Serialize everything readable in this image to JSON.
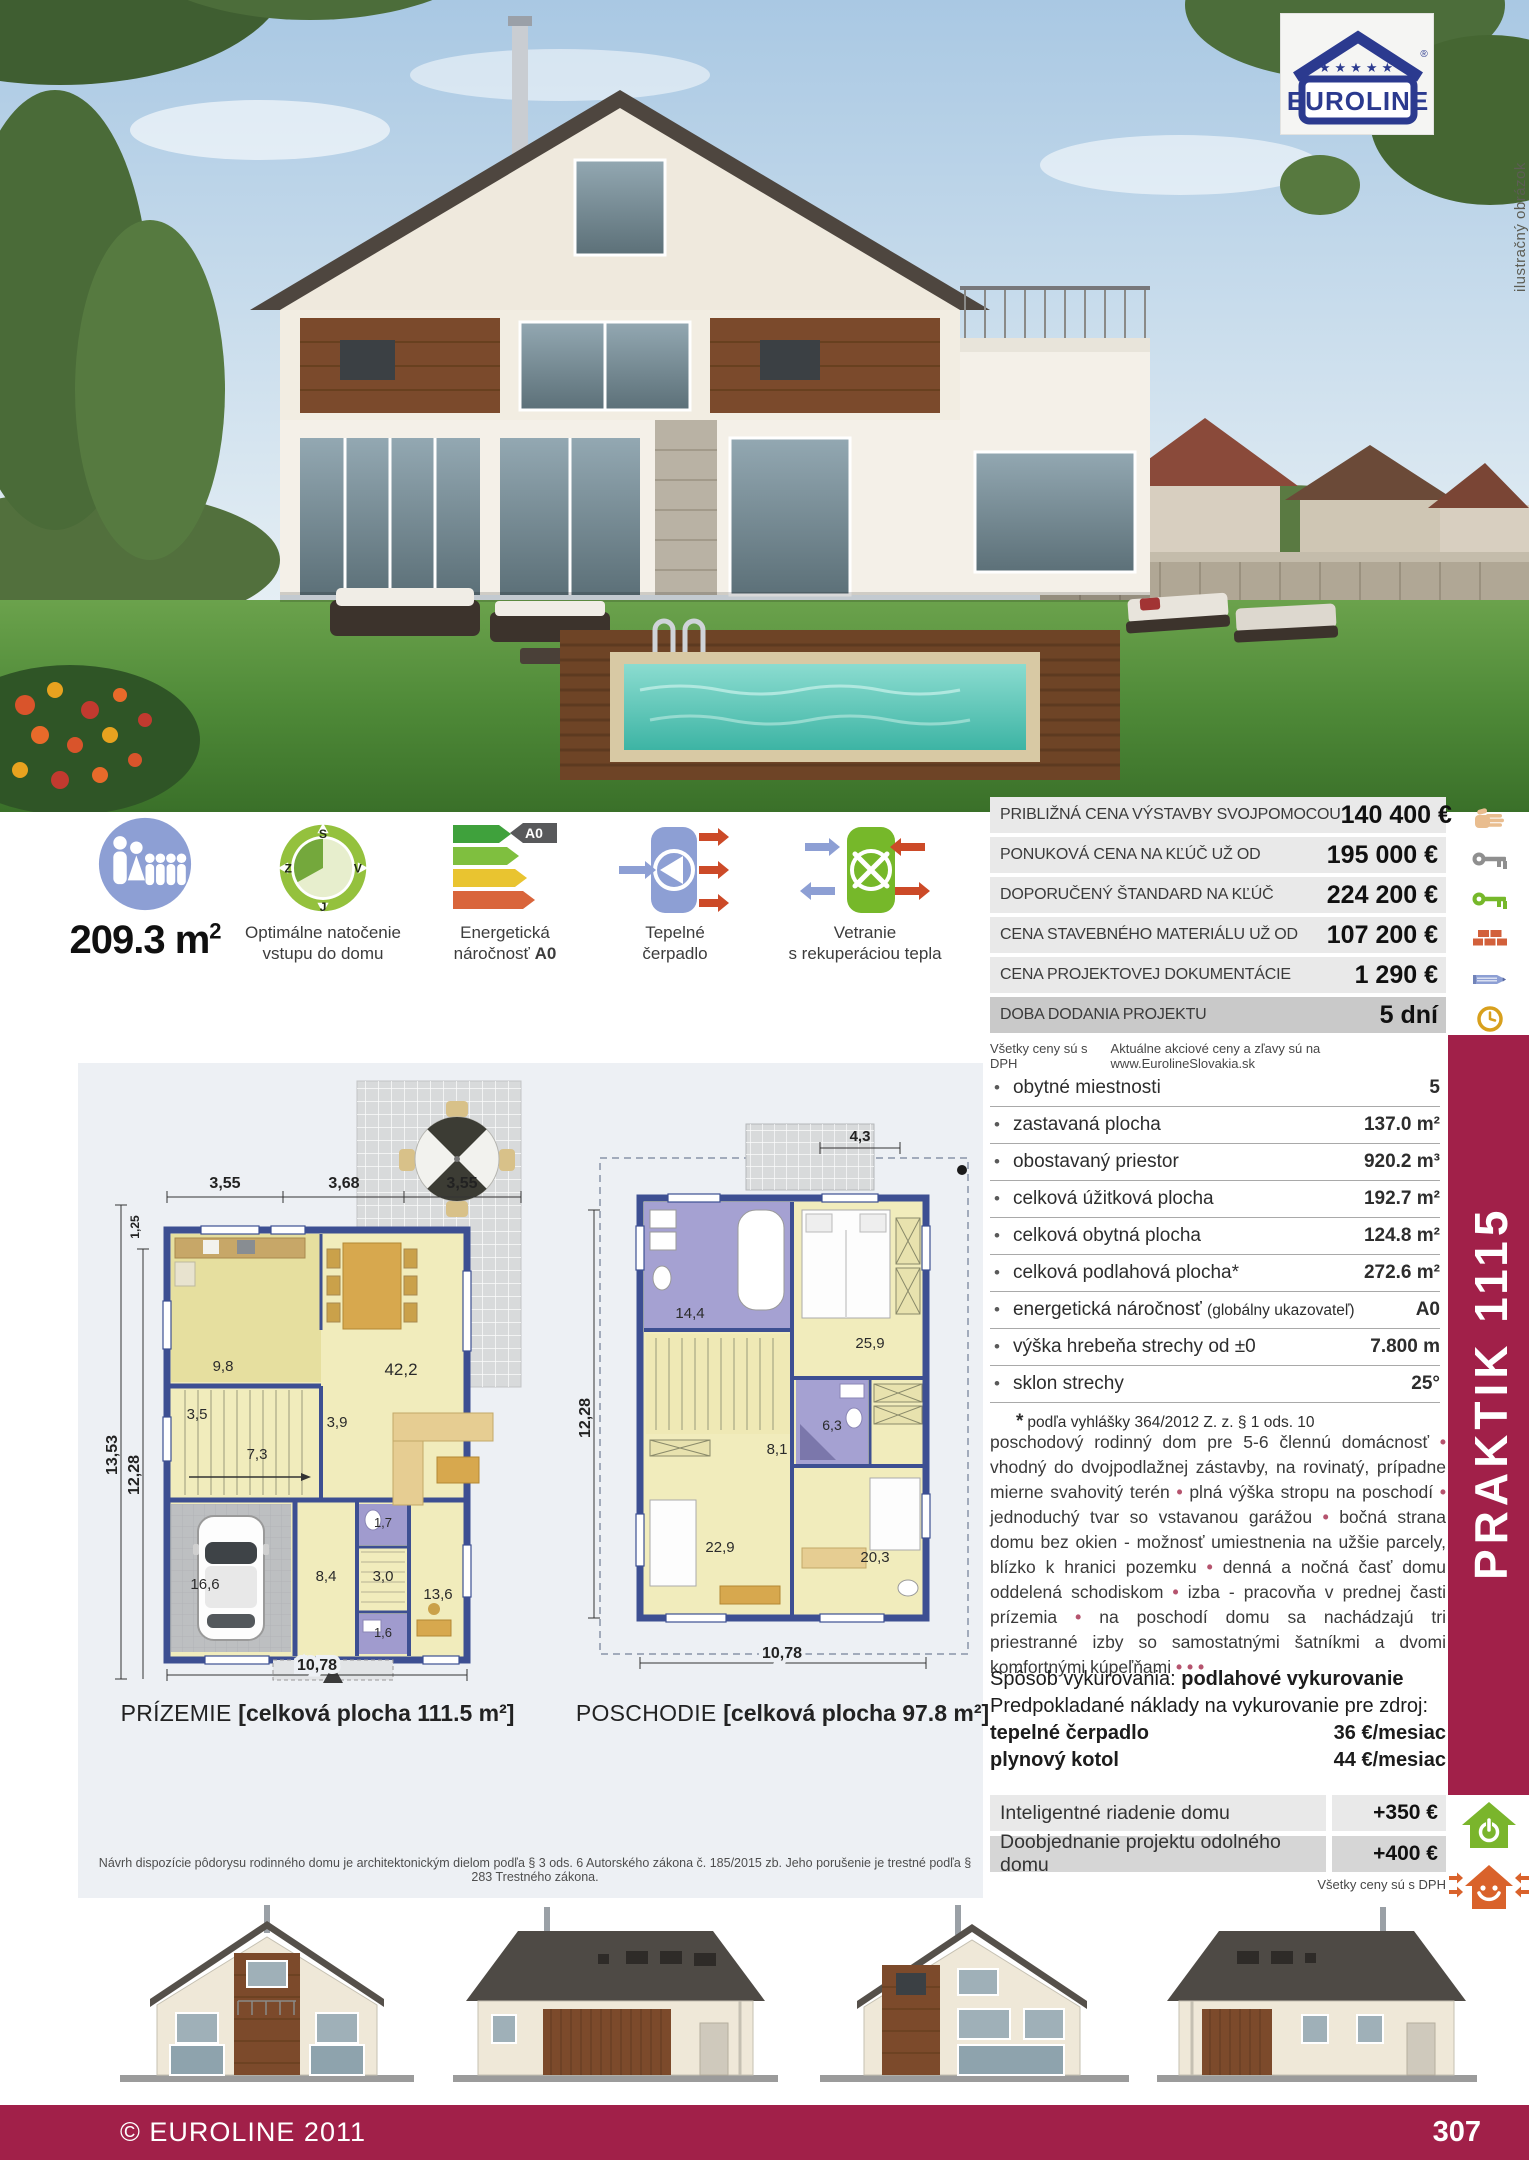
{
  "logo": {
    "brand": "EUROLINE",
    "registered": "®",
    "stars": "★★★★★"
  },
  "photo_note": "ilustračný obrázok",
  "model": "PRAKTIK 1115",
  "colors": {
    "maroon": "#a12049",
    "periwinkle": "#8d9fd4",
    "leaf_green": "#76b82a",
    "orange_red": "#cc4a28"
  },
  "summary": {
    "area_main": "209.3 m",
    "area_exp": "2",
    "compass": {
      "n": "S",
      "e": "V",
      "s": "J",
      "w": "Z",
      "label_line1": "Optimálne natočenie",
      "label_line2": "vstupu do domu"
    },
    "energy": {
      "label_line1": "Energetická",
      "label_line2": "náročnosť",
      "grade": "A0"
    },
    "heatpump": {
      "label_line1": "Tepelné",
      "label_line2": "čerpadlo"
    },
    "ventilation": {
      "label_line1": "Vetranie",
      "label_line2": "s rekuperáciou tepla"
    }
  },
  "price_table": {
    "rows": [
      {
        "label": "PRIBLIŽNÁ CENA VÝSTAVBY SVOJPOMOCOU",
        "value": "140 400 €"
      },
      {
        "label": "PONUKOVÁ CENA NA KĽÚČ UŽ OD",
        "value": "195 000 €"
      },
      {
        "label": "DOPORUČENÝ ŠTANDARD NA KĽÚČ",
        "value": "224 200 €"
      },
      {
        "label": "CENA STAVEBNÉHO MATERIÁLU UŽ OD",
        "value": "107 200 €"
      },
      {
        "label": "CENA PROJEKTOVEJ DOKUMENTÁCIE",
        "value": "1 290 €"
      },
      {
        "label": "DOBA DODANIA PROJEKTU",
        "value": "5 dní"
      }
    ],
    "note_left": "Všetky ceny sú s DPH",
    "note_right": "Aktuálne akciové ceny a zľavy sú na www.EurolineSlovakia.sk"
  },
  "specs": {
    "rows": [
      {
        "label": "obytné miestnosti",
        "value": "5"
      },
      {
        "label": "zastavaná plocha",
        "value": "137.0 m²"
      },
      {
        "label": "obostavaný priestor",
        "value": "920.2 m³"
      },
      {
        "label": "celková úžitková plocha",
        "value": "192.7 m²"
      },
      {
        "label": "celková obytná plocha",
        "value": "124.8 m²"
      },
      {
        "label": "celková podlahová plocha*",
        "value": "272.6 m²"
      },
      {
        "label": "energetická náročnosť",
        "label_small": "(globálny ukazovateľ)",
        "value": "A0"
      },
      {
        "label": "výška hrebeňa strechy od ±0",
        "value": "7.800 m"
      },
      {
        "label": "sklon strechy",
        "value": "25°"
      }
    ],
    "footnote_star": "*",
    "footnote": "podľa vyhlášky 364/2012 Z. z. § 1 ods. 10"
  },
  "description": {
    "segments": [
      "poschodový rodinný dom pre 5-6 člennú domácnosť",
      "vhodný do dvojpodlažnej zástavby, na rovinatý, prípadne mierne svahovitý terén",
      "plná výška stropu na poschodí",
      "jednoduchý tvar so vstavanou garážou",
      "bočná strana domu bez okien - možnosť umiestnenia na užšie parcely, blízko k hranici pozemku",
      "denná a nočná časť domu oddelená schodiskom",
      "izba - pracovňa v prednej časti prízemia",
      "na poschodí domu sa nachádzajú tri priestranné izby so samostatnými šatníkmi a dvomi komfortnými kúpeľňami"
    ],
    "trailing_bullets": "• • •"
  },
  "heating": {
    "method_label": "Spôsob vykurovania:",
    "method_value": "podlahové vykurovanie",
    "costs_intro": "Predpokladané náklady na vykurovanie pre zdroj:",
    "rows": [
      {
        "label": "tepelné čerpadlo",
        "value": "36 €/mesiac"
      },
      {
        "label": "plynový kotol",
        "value": "44 €/mesiac"
      }
    ]
  },
  "options": {
    "rows": [
      {
        "label": "Inteligentné riadenie domu",
        "value": "+350 €"
      },
      {
        "label": "Doobjednanie projektu odolného domu",
        "value": "+400 €"
      }
    ],
    "note": "Všetky ceny sú s DPH"
  },
  "floorplans": {
    "ground": {
      "title": "PRÍZEMIE",
      "area": "[celková plocha 111.5 m²]",
      "dims": {
        "top1": "3,55",
        "top2": "3,68",
        "top3": "3,55",
        "left_outer": "13,53",
        "left_inner": "12,28",
        "left_top": "1,25",
        "bottom": "10,78"
      },
      "rooms": {
        "kitchen": "9,8",
        "living": "42,2",
        "hall": "3,5",
        "corridor": "3,9",
        "stairs": "7,3",
        "garage": "16,6",
        "hallway": "8,4",
        "pantry": "3,0",
        "study": "13,6",
        "wc": "1,7",
        "tech": "1,6"
      }
    },
    "upper": {
      "title": "POSCHODIE",
      "area": "[celková plocha 97.8 m²]",
      "dims": {
        "top": "4,3",
        "left": "12,28",
        "bottom": "10,78"
      },
      "rooms": {
        "bathroom": "14,4",
        "bedroom": "25,9",
        "hall": "8,1",
        "bathroom2": "6,3",
        "room1": "22,9",
        "room2": "20,3"
      }
    }
  },
  "disclaimer": "Návrh dispozície pôdorysu rodinného domu je architektonickým dielom podľa § 3 ods. 6 Autorského zákona č. 185/2015 zb. Jeho porušenie je trestné podľa § 283 Trestného zákona.",
  "footer": {
    "copyright": "© EUROLINE 2011",
    "page": "307"
  }
}
